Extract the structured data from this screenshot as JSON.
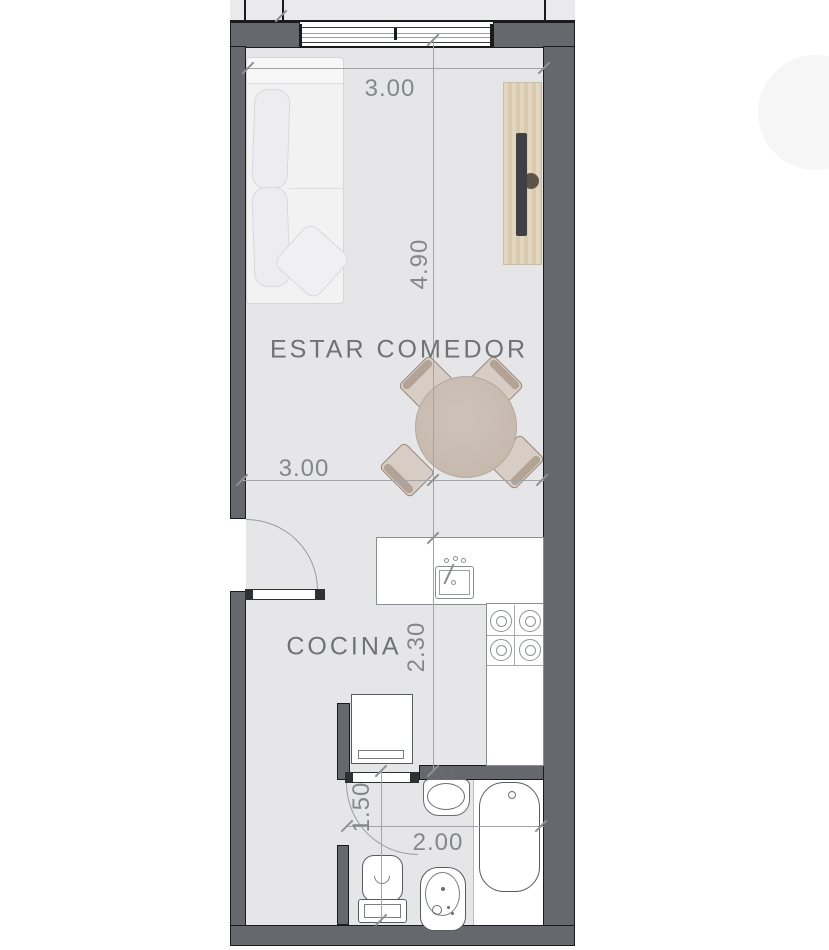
{
  "plan": {
    "rooms": {
      "living_dining": {
        "label": "ESTAR COMEDOR"
      },
      "kitchen": {
        "label": "COCINA"
      }
    },
    "dimensions": {
      "top_width": "3.00",
      "living_height": "4.90",
      "living_width": "3.00",
      "kitchen_depth": "2.30",
      "bath_height": "1.50",
      "bath_width": "2.00"
    },
    "furniture": [
      "sofa",
      "tv-unit",
      "dining-table",
      "dining-chairs",
      "kitchen-sink",
      "stove-burners",
      "refrigerator",
      "washbasin",
      "bathtub",
      "toilet",
      "bidet"
    ],
    "colors": {
      "wall": "#65696e",
      "floor": "#e6e6e8",
      "dimension_line": "#a2a4a6",
      "dimension_text": "#85878a",
      "label_text": "#6f7174",
      "wood": "#ddd0b8",
      "tv": "#3e4043",
      "table": "#c9bcb1",
      "chair": "#d8cdc4"
    }
  }
}
